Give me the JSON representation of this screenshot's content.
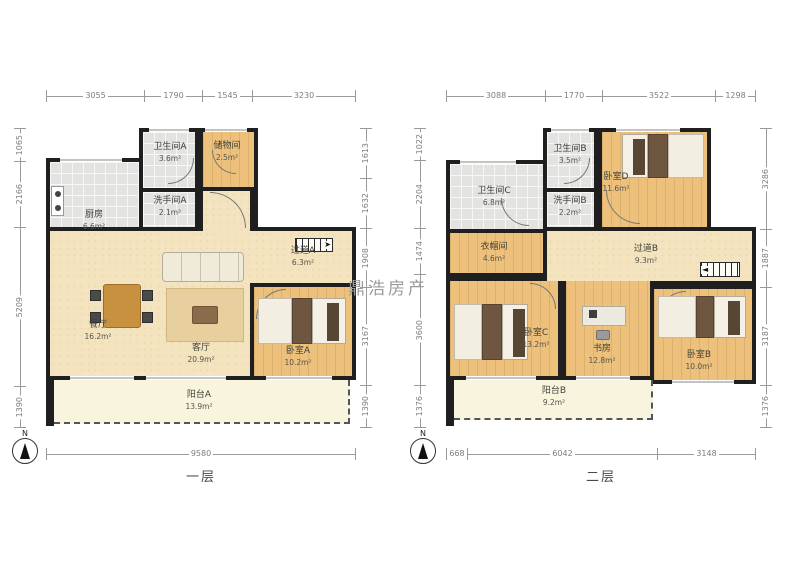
{
  "watermark": "鼎浩房产",
  "plans": [
    {
      "floor_label": "一层",
      "north_label": "N",
      "dims": {
        "top": [
          "3055",
          "1790",
          "1545",
          "3230"
        ],
        "left": [
          "1065",
          "2166",
          "5209",
          "1390"
        ],
        "right": [
          "1613",
          "1632",
          "1908",
          "3167",
          "1390"
        ],
        "bottom": [
          "9580"
        ]
      },
      "rooms": [
        {
          "name": "厨房",
          "area": "6.6m²"
        },
        {
          "name": "卫生间A",
          "area": "3.6m²"
        },
        {
          "name": "储物间",
          "area": "2.5m²"
        },
        {
          "name": "洗手间A",
          "area": "2.1m²"
        },
        {
          "name": "过道A",
          "area": "6.3m²"
        },
        {
          "name": "餐厅",
          "area": "16.2m²"
        },
        {
          "name": "客厅",
          "area": "20.9m²"
        },
        {
          "name": "卧室A",
          "area": "10.2m²"
        },
        {
          "name": "阳台A",
          "area": "13.9m²"
        }
      ]
    },
    {
      "floor_label": "二层",
      "north_label": "N",
      "dims": {
        "top": [
          "3088",
          "1770",
          "3522",
          "1298"
        ],
        "left": [
          "1022",
          "2204",
          "1474",
          "3600",
          "1376"
        ],
        "right": [
          "3286",
          "1887",
          "3187",
          "1376"
        ],
        "bottom": [
          "668",
          "6042",
          "3148"
        ]
      },
      "rooms": [
        {
          "name": "卫生间C",
          "area": "6.8m²"
        },
        {
          "name": "卫生间B",
          "area": "3.5m²"
        },
        {
          "name": "洗手间B",
          "area": "2.2m²"
        },
        {
          "name": "卧室D",
          "area": "11.6m²"
        },
        {
          "name": "衣帽间",
          "area": "4.6m²"
        },
        {
          "name": "过道B",
          "area": "9.3m²"
        },
        {
          "name": "卧室C",
          "area": "13.2m²"
        },
        {
          "name": "书房",
          "area": "12.8m²"
        },
        {
          "name": "卧室B",
          "area": "10.0m²"
        },
        {
          "name": "阳台B",
          "area": "9.2m²"
        }
      ]
    }
  ]
}
